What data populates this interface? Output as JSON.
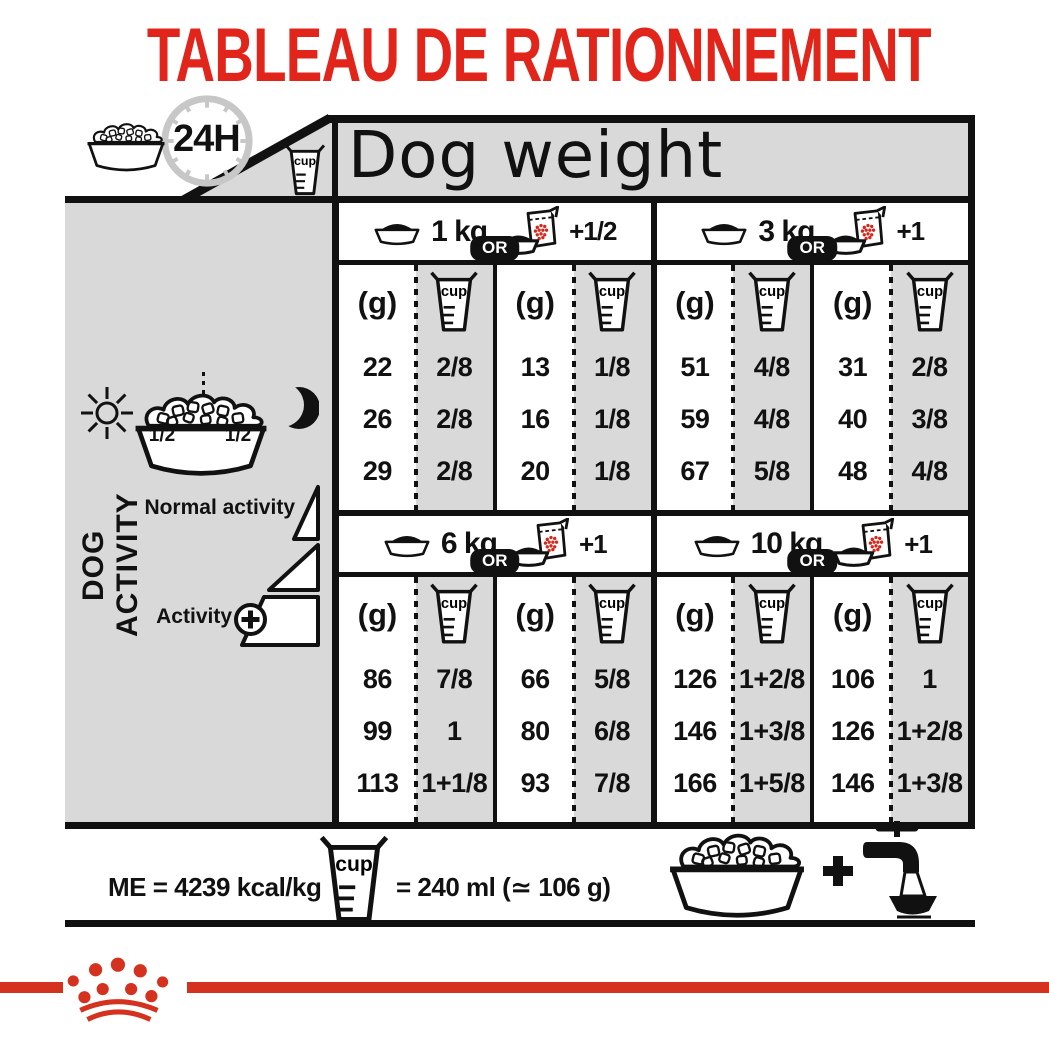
{
  "title": "TABLEAU DE RATIONNEMENT",
  "header": {
    "hours": "24H",
    "dog_weight": "Dog weight"
  },
  "sidebar": {
    "label": "DOG ACTIVITY",
    "half_left": "1/2",
    "half_right": "1/2",
    "normal": "Normal activity",
    "active": "Activity"
  },
  "table": {
    "or": "OR",
    "g": "(g)",
    "cup": "cup",
    "sections": [
      {
        "weight": "1 kg",
        "alt": "+1/2",
        "g1": [
          "22",
          "26",
          "29"
        ],
        "c1": [
          "2/8",
          "2/8",
          "2/8"
        ],
        "g2": [
          "13",
          "16",
          "20"
        ],
        "c2": [
          "1/8",
          "1/8",
          "1/8"
        ]
      },
      {
        "weight": "3 kg",
        "alt": "+1",
        "g1": [
          "51",
          "59",
          "67"
        ],
        "c1": [
          "4/8",
          "4/8",
          "5/8"
        ],
        "g2": [
          "31",
          "40",
          "48"
        ],
        "c2": [
          "2/8",
          "3/8",
          "4/8"
        ]
      },
      {
        "weight": "6 kg",
        "alt": "+1",
        "g1": [
          "86",
          "99",
          "113"
        ],
        "c1": [
          "7/8",
          "1",
          "1+1/8"
        ],
        "g2": [
          "66",
          "80",
          "93"
        ],
        "c2": [
          "5/8",
          "6/8",
          "7/8"
        ]
      },
      {
        "weight": "10 kg",
        "alt": "+1",
        "g1": [
          "126",
          "146",
          "166"
        ],
        "c1": [
          "1+2/8",
          "1+3/8",
          "1+5/8"
        ],
        "g2": [
          "106",
          "126",
          "146"
        ],
        "c2": [
          "1",
          "1+2/8",
          "1+3/8"
        ]
      }
    ]
  },
  "footer": {
    "me": "ME = 4239 kcal/kg",
    "equiv": "= 240 ml (≃ 106 g)"
  },
  "icons": {
    "clock-icon": "gray ring with ticks",
    "food-bowl-icon": "bowl with kibble",
    "measuring-cup-icon": "tapered cup",
    "pouch-bowl-icon": "bowl + kibble pouch with red dots",
    "sun-icon": "circle with rays",
    "moon-icon": "crescent",
    "plus-circle-icon": "⊕",
    "plus-icon": "+",
    "tap-icon": "faucet pouring into bowl",
    "crown-logo-icon": "9 red dots with two arcs"
  },
  "colors": {
    "accent_red": "#d5311f",
    "panel_gray": "#d9d9d9",
    "ink_black": "#111111"
  }
}
